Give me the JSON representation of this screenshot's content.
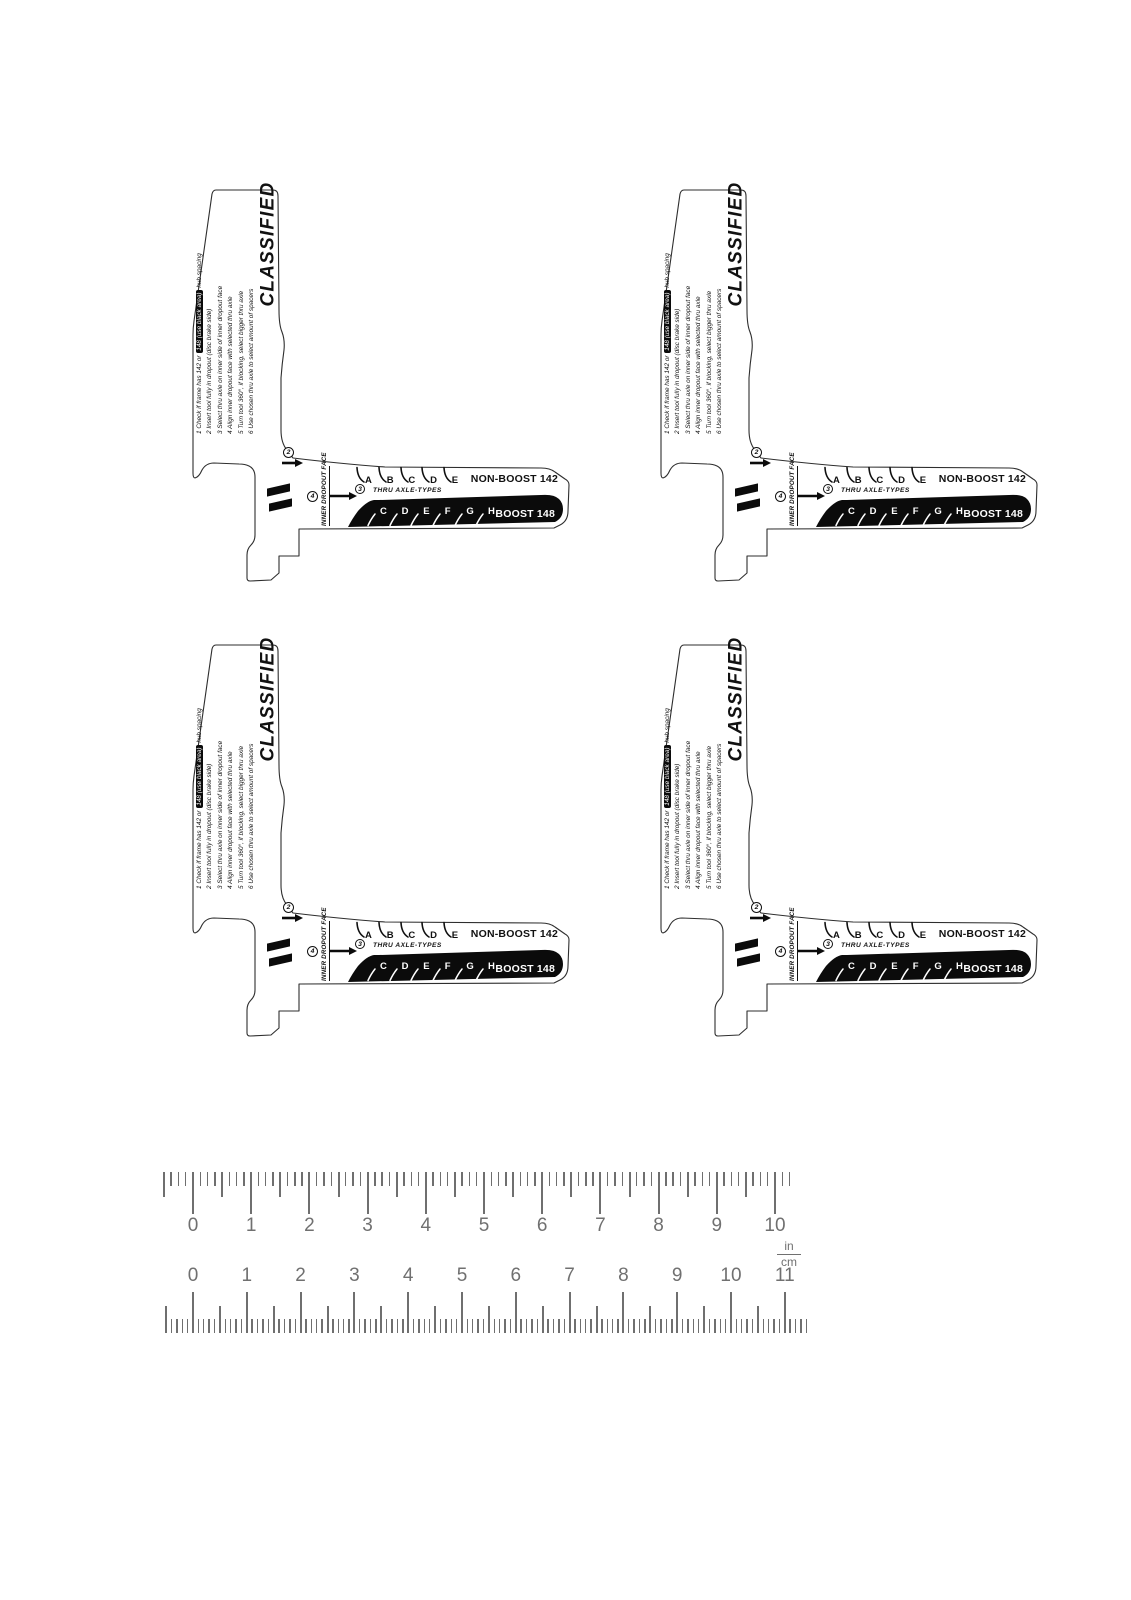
{
  "tool": {
    "brand": "CLASSIFIED",
    "step_markers": [
      "2",
      "3",
      "4"
    ],
    "instructions": {
      "line1_pre": "1  Check if frame has 142 or ",
      "line1_highlight": "148 (use black area)",
      "line1_post": " hub spacing",
      "lines": [
        "2  Insert tool fully in dropout (disc brake side)",
        "3  Select thru axle on inner side of inner dropout face",
        "4  Align inner dropout face with selected thru axle",
        "5  Turn tool 360°, if blocking, select bigger thru axle",
        "6  Use chosen thru axle to select amount of spacers"
      ]
    },
    "inner_dropout_face": "INNER DROPOUT FACE",
    "thru_axle_types": "THRU AXLE-TYPES",
    "non_boost_label": "NON-BOOST 142",
    "boost_label": "BOOST 148",
    "non_boost_letters": [
      "A",
      "B",
      "C",
      "D",
      "E"
    ],
    "boost_letters": [
      "C",
      "D",
      "E",
      "F",
      "G",
      "H"
    ],
    "colors": {
      "ink": "#111111",
      "band": "#0b0b0b"
    }
  },
  "ruler": {
    "inch": {
      "numbers": [
        "0",
        "1",
        "2",
        "3",
        "4",
        "5",
        "6",
        "7",
        "8",
        "9",
        "10"
      ],
      "subdivisions_per_unit": 8,
      "tick_range": [
        -0.5,
        10.25
      ]
    },
    "cm": {
      "numbers": [
        "0",
        "1",
        "2",
        "3",
        "4",
        "5",
        "6",
        "7",
        "8",
        "9",
        "10",
        "11"
      ],
      "subdivisions_per_unit": 10,
      "tick_range": [
        -0.5,
        11.4
      ]
    },
    "unit_top": "in",
    "unit_bottom": "cm",
    "color": "#6f6f6f"
  }
}
